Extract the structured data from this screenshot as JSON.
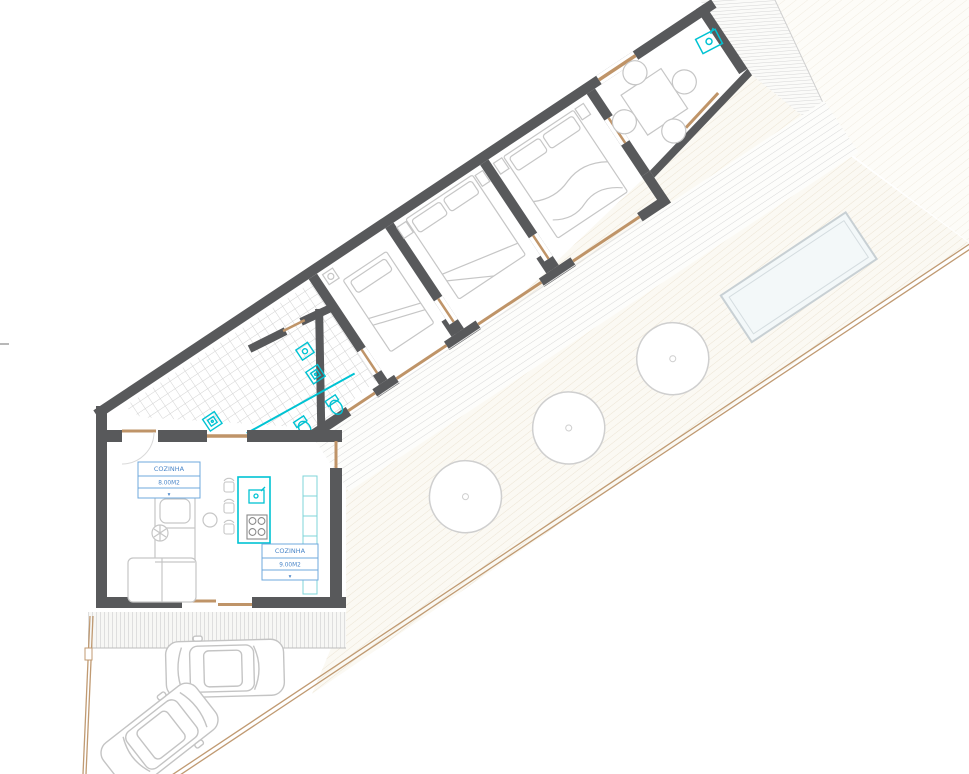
{
  "drawing": {
    "type": "architectural-floor-plan",
    "labels": {
      "room1": {
        "name": "COZINHA",
        "area": "8.00M2",
        "mark": "▾"
      },
      "room2": {
        "name": "COZINHA",
        "area": "9.00M2",
        "mark": "▾"
      }
    },
    "objects": {
      "bedrooms": 3,
      "bathrooms": 2,
      "trees": 3,
      "cars": 2,
      "pool": 1,
      "dining_table_seats": 4
    },
    "colors": {
      "wall": "#58595b",
      "wood_sill": "#bf9468",
      "boundary": "#c09a72",
      "fixture_cyan": "#00c3d3",
      "label_blue": "#5b9bd5",
      "furniture_line": "#c6c6c6",
      "tile_line": "#d2d2d2",
      "terrace_hatch": "#ece4d4",
      "deck_hatch": "#d9d9d9",
      "pool_fill": "#f3f8f9"
    }
  }
}
